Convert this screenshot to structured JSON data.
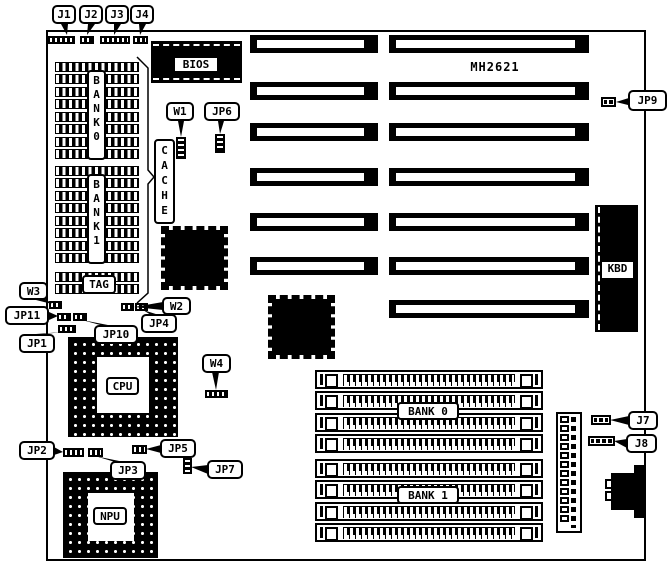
{
  "board": {
    "model_text": "MH2621"
  },
  "callouts": {
    "j1": "J1",
    "j2": "J2",
    "j3": "J3",
    "j4": "J4",
    "w1": "W1",
    "jp6": "JP6",
    "jp9": "JP9",
    "w3": "W3",
    "jp11": "JP11",
    "jp1": "JP1",
    "jp10": "JP10",
    "w2": "W2",
    "jp4": "JP4",
    "w4": "W4",
    "jp2": "JP2",
    "jp3": "JP3",
    "jp5": "JP5",
    "jp7": "JP7",
    "j7": "J7",
    "j8": "J8"
  },
  "chips": {
    "bios": "BIOS",
    "cpu": "CPU",
    "npu": "NPU",
    "kbd": "KBD",
    "cache": "CACHE",
    "tag": "TAG",
    "sram_bank0": "BANK0",
    "sram_bank1": "BANK1",
    "simm_bank0": "BANK 0",
    "simm_bank1": "BANK 1"
  },
  "colors": {
    "ink": "#000000",
    "paper": "#ffffff"
  }
}
